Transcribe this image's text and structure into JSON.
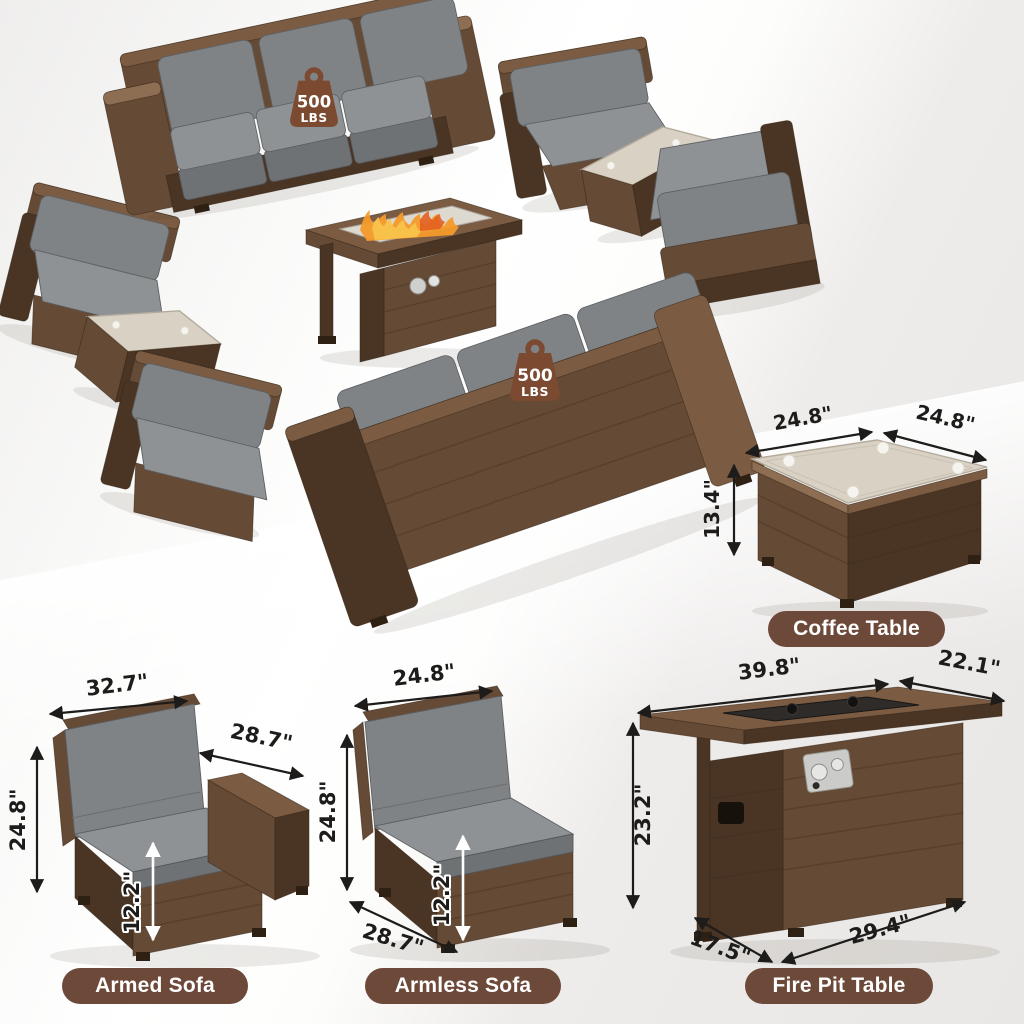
{
  "badge": {
    "value": "500",
    "unit": "LBS"
  },
  "coffee_table": {
    "label": "Coffee Table",
    "dims": {
      "top_width": "24.8\"",
      "top_depth": "24.8\"",
      "height": "13.4\""
    }
  },
  "armed_sofa": {
    "label": "Armed Sofa",
    "dims": {
      "back_width": "32.7\"",
      "depth": "28.7\"",
      "height": "24.8\"",
      "seat_height": "12.2\""
    }
  },
  "armless_sofa": {
    "label": "Armless Sofa",
    "dims": {
      "width": "24.8\"",
      "height": "24.8\"",
      "seat_height": "12.2\"",
      "depth": "28.7\""
    }
  },
  "fire_pit_table": {
    "label": "Fire Pit Table",
    "dims": {
      "top_width": "39.8\"",
      "top_depth": "22.1\"",
      "height": "23.2\"",
      "base_depth": "17.5\"",
      "base_width": "29.4\""
    }
  },
  "colors": {
    "label_pill": "#6d4939",
    "badge": "#7b4a31",
    "dimension_text": "#1d1c1b",
    "wicker": "#654a36",
    "cushion": "#8f9295"
  }
}
